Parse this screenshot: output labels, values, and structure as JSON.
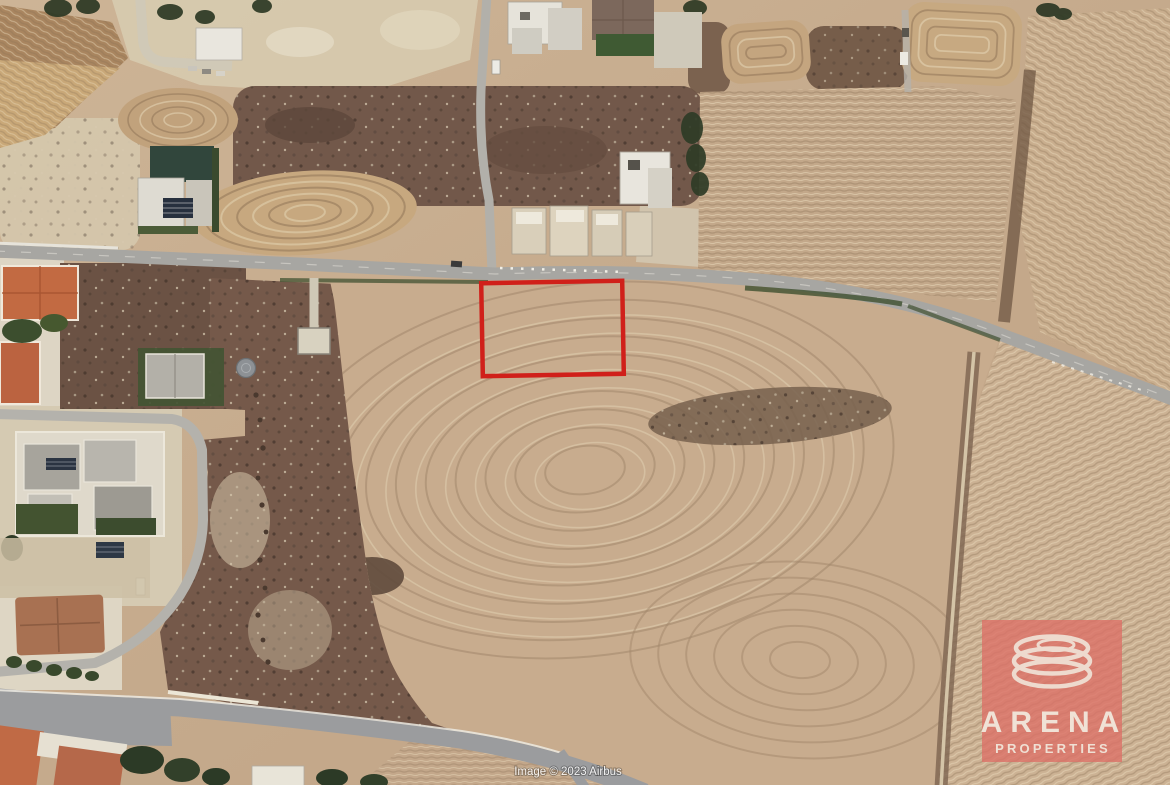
{
  "scene": {
    "type": "satellite-aerial-photo",
    "description": "Aerial view of plowed fields, roads and houses with a plot boundary highlighted",
    "palette": {
      "field_tan": "#c6ab8c",
      "field_light": "#decfb2",
      "furrow_dark": "#8d7258",
      "scrub_brown": "#6f574a",
      "road_gray": "#a7a6a2",
      "road_dark_gray": "#9b9c9e",
      "vegetation_dark": "#2f3b26",
      "roof_orange": "#c06a45",
      "roof_gray": "#a7a49c",
      "building_white": "#e9e6de"
    }
  },
  "plot_marker": {
    "shape": "rectangle",
    "color": "#d0201a"
  },
  "watermark": {
    "brand": "ARENA",
    "subtitle": "PROPERTIES",
    "panel_color": "#dd6f66",
    "text_color": "#f2ebdf"
  },
  "attribution": {
    "text": "Image © 2023 Airbus"
  }
}
